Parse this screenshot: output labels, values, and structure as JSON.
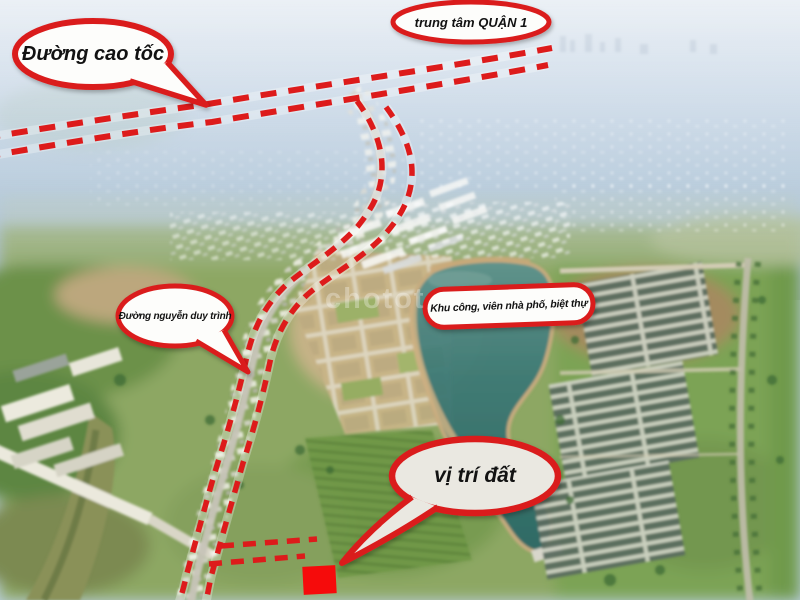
{
  "callouts": {
    "highway": "Đường cao tốc",
    "district_center": "trung tâm QUẬN 1",
    "street": "Đường nguyễn duy trình",
    "area": "Khu công, viên nhà phố, biệt thự",
    "site": "vị trí đất"
  },
  "watermark": {
    "text": "chotot"
  },
  "colors": {
    "annotation_red": "#dd1b1b",
    "marker_red": "#f60b0b",
    "callout_fill": "#fdfdfb",
    "lake_teal": "#3c7773",
    "haze_blue": "#bcd0e2"
  }
}
